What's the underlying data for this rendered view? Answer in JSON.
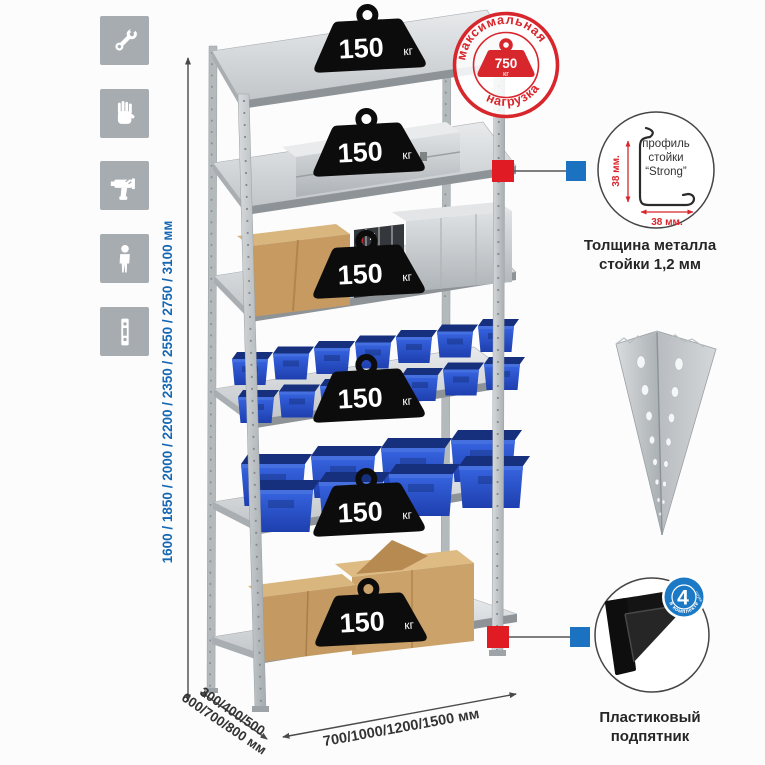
{
  "illustration": {
    "shelf_badge": {
      "value": "150",
      "unit": "кг"
    },
    "max_load_stamp": {
      "arc_top": "максимальная",
      "arc_bottom": "нагрузка",
      "value": "750",
      "unit": "кг"
    },
    "height_options": "1600 / 1850 / 2000 / 2200 / 2350 / 2550 / 2750 / 3100 мм",
    "depth_options_line1": "300/400/500",
    "depth_options_line2": "600/700/800 мм",
    "width_options": "700/1000/1200/1500 мм"
  },
  "profile_detail": {
    "label_line1": "профиль",
    "label_line2": "стойки",
    "label_line3": "“Strong”",
    "dim_vertical": "38 мм.",
    "dim_horizontal": "38 мм.",
    "caption_line1": "Толщина металла",
    "caption_line2": "стойки 1,2 мм"
  },
  "foot_detail": {
    "badge_value": "4",
    "badge_note": "штуки",
    "badge_arc": "в комплекте",
    "caption_line1": "Пластиковый",
    "caption_line2": "подпятник"
  },
  "sidebar_icons": [
    {
      "name": "wrench-icon"
    },
    {
      "name": "gloves-icon"
    },
    {
      "name": "drill-icon"
    },
    {
      "name": "person-icon"
    },
    {
      "name": "rack-post-icon"
    }
  ],
  "colors": {
    "accent_red": "#d7262c",
    "accent_blue": "#1a72c0",
    "dim_text_blue": "#1567b3",
    "bin_blue": "#2a55cd",
    "icon_gray": "#a7acb0"
  }
}
